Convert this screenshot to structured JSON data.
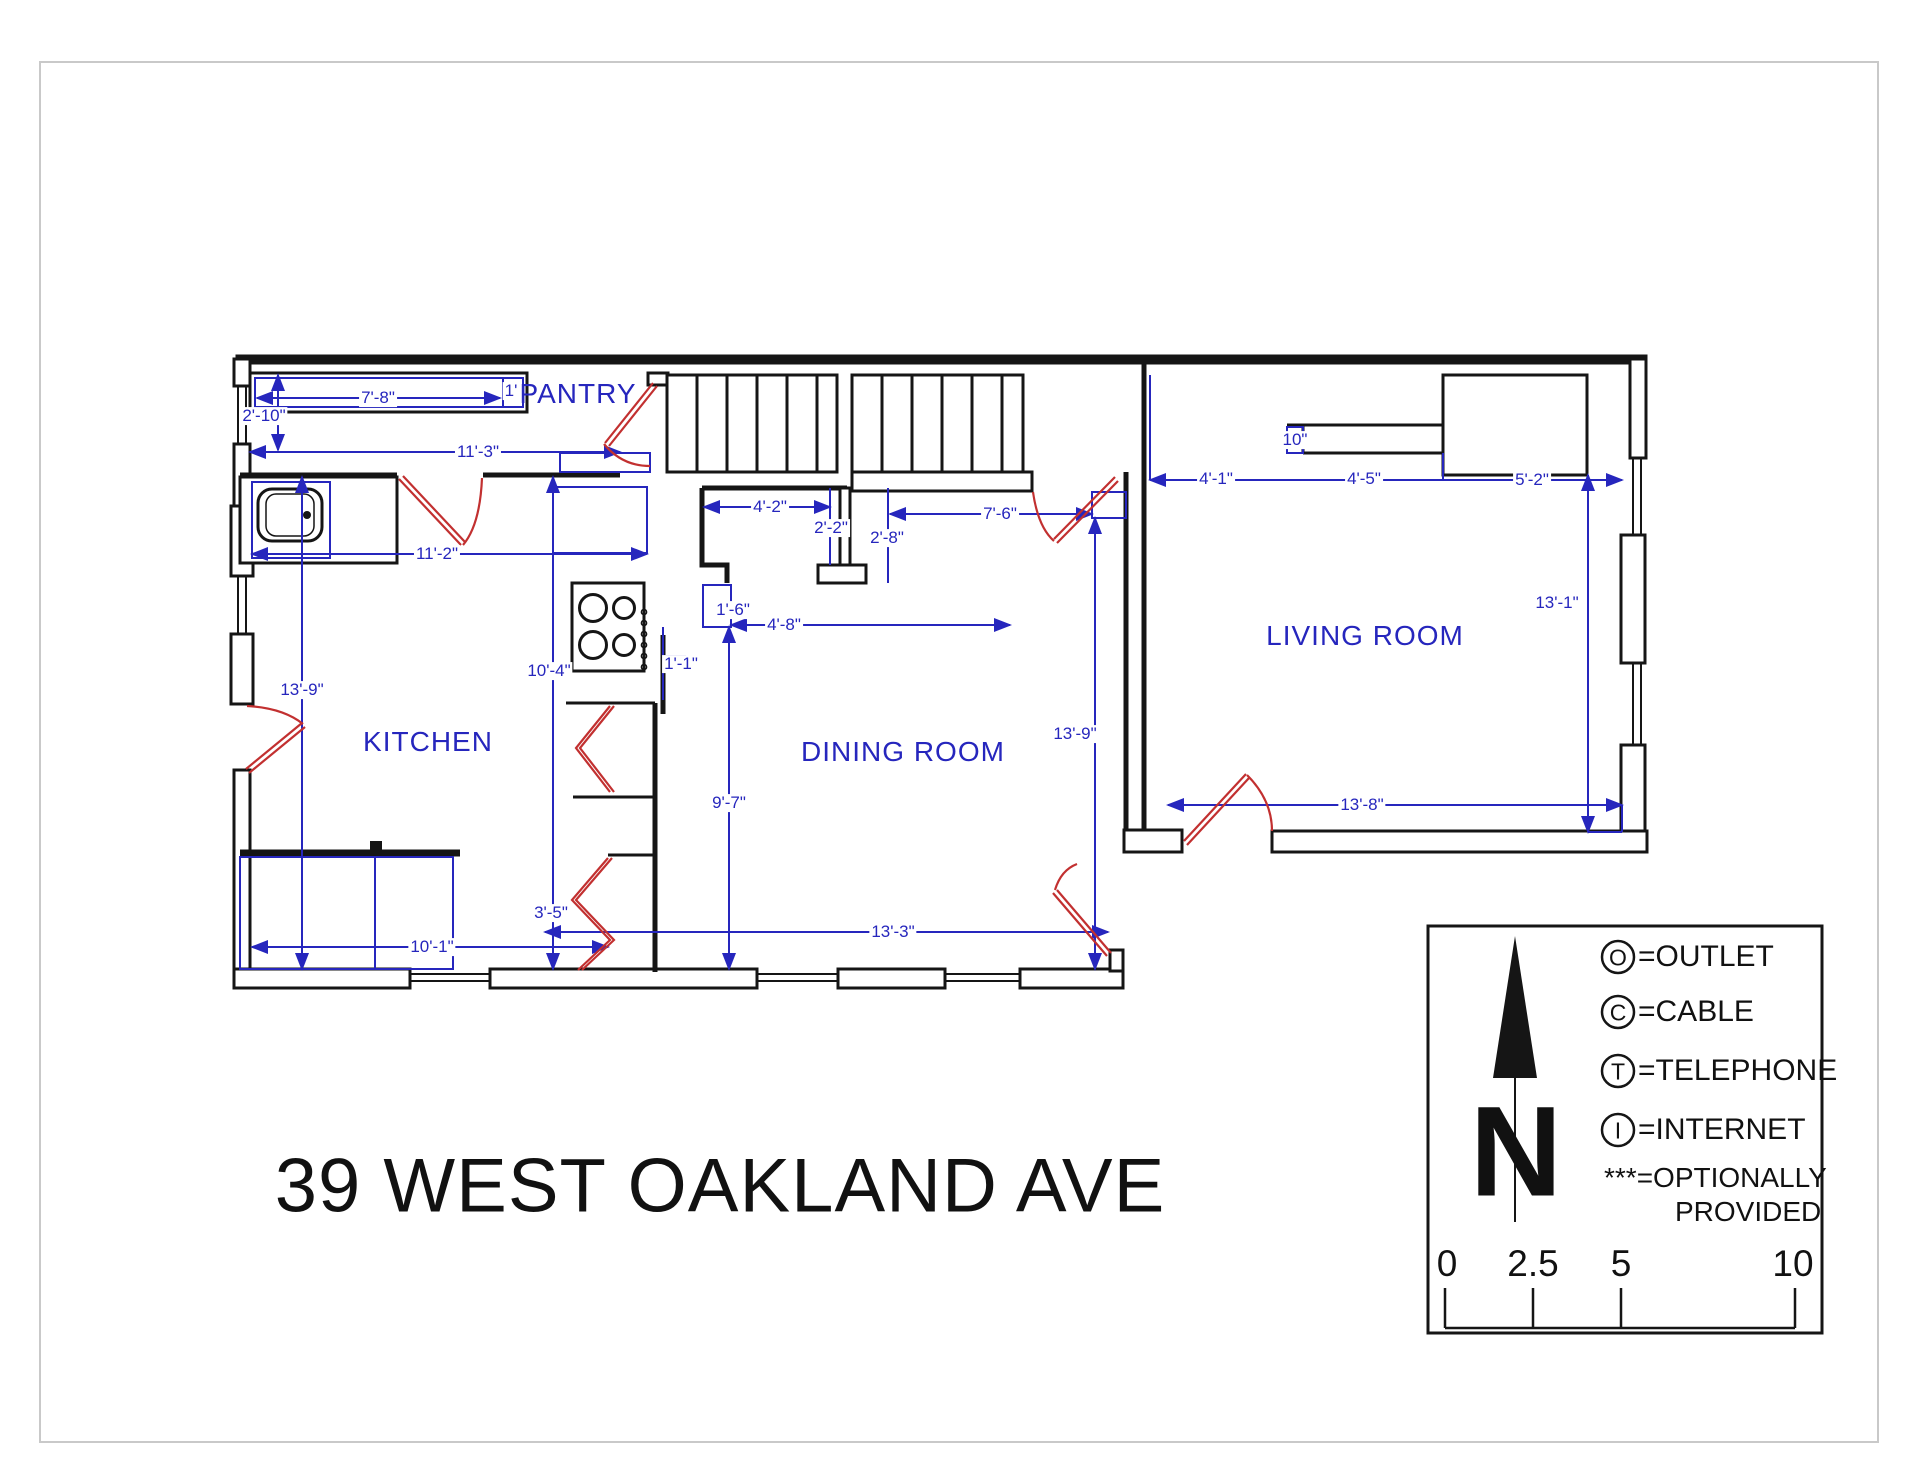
{
  "title": "39 WEST OAKLAND AVE",
  "rooms": {
    "pantry": "PANTRY",
    "kitchen": "KITCHEN",
    "dining": "DINING ROOM",
    "living": "LIVING ROOM"
  },
  "dims": {
    "d1": "7'-8\"",
    "d2": "1'",
    "d3": "2'-10\"",
    "d4": "11'-3\"",
    "d5": "11'-2\"",
    "d6": "13'-9\"",
    "d7": "10'-4\"",
    "d8": "3'-5\"",
    "d9": "10'-1\"",
    "d10": "4'-2\"",
    "d11": "2'-2\"",
    "d12": "2'-8\"",
    "d13": "7'-6\"",
    "d14": "1'-6\"",
    "d15": "4'-8\"",
    "d16": "1'-1\"",
    "d17": "9'-7\"",
    "d18": "13'-3\"",
    "d19": "13'-9\"",
    "d20": "4'-1\"",
    "d21": "10\"",
    "d22": "4'-5\"",
    "d23": "5'-2\"",
    "d24": "13'-1\"",
    "d25": "13'-8\""
  },
  "legend": {
    "north_letter": "N",
    "items": [
      {
        "symbol": "O",
        "label": "=OUTLET"
      },
      {
        "symbol": "C",
        "label": "=CABLE"
      },
      {
        "symbol": "T",
        "label": "=TELEPHONE"
      },
      {
        "symbol": "I",
        "label": "=INTERNET"
      }
    ],
    "optional": {
      "line1": "***=OPTIONALLY",
      "line2": "PROVIDED"
    }
  },
  "scale_bar": {
    "ticks": [
      "0",
      "2.5",
      "5",
      "10"
    ]
  },
  "colors": {
    "wall_black": "#151515",
    "dim_blue": "#2626bd",
    "door_red": "#c23030",
    "frame_gray": "#c9c9c9"
  }
}
